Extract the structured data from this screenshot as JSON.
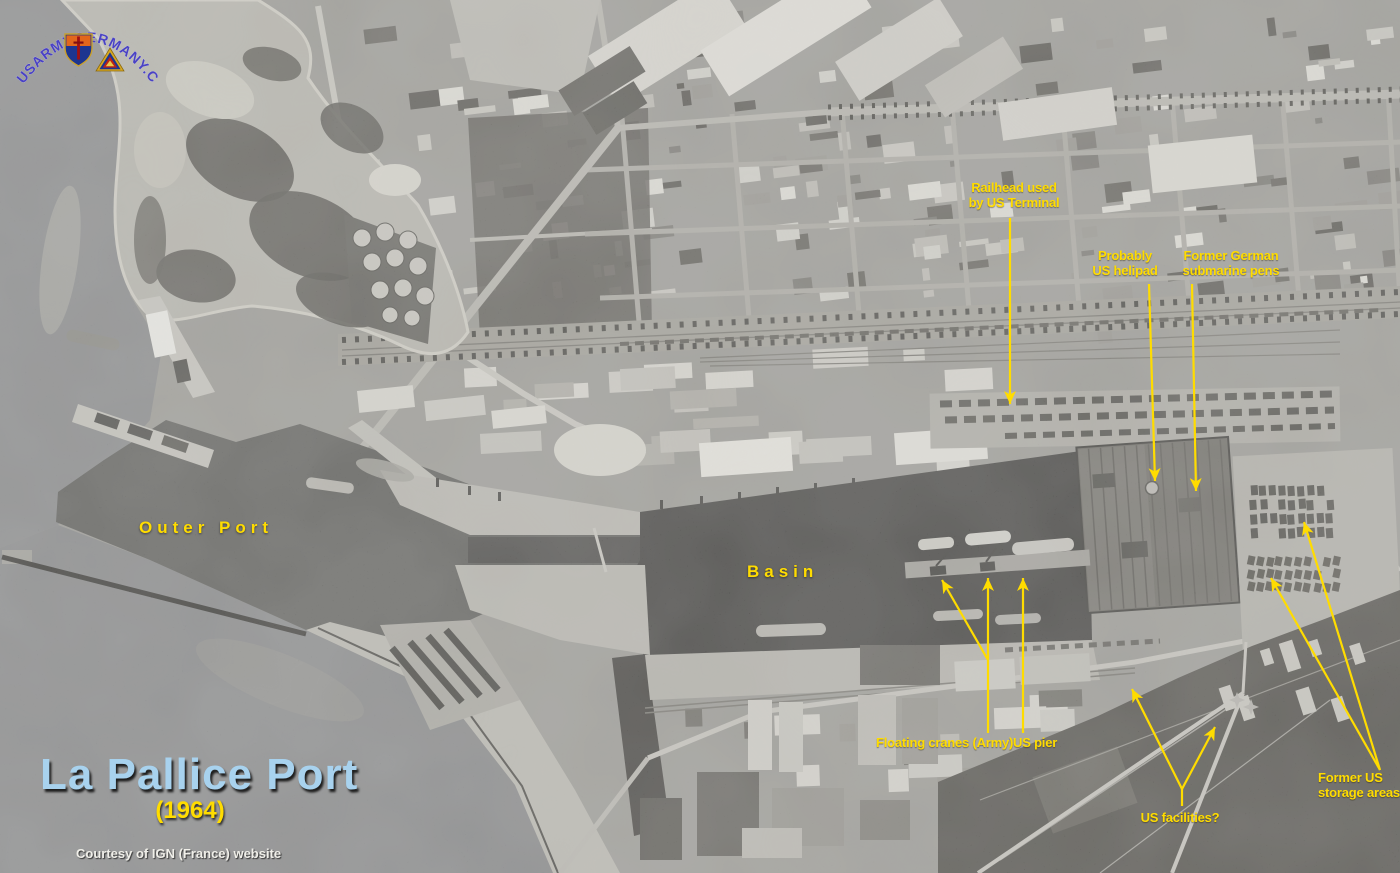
{
  "logo": {
    "text": "USARMYGERMANY.COM"
  },
  "title": {
    "main": "La Pallice Port",
    "year": "(1964)",
    "credit": "Courtesy of IGN (France) website"
  },
  "place_labels": {
    "outer_port": "Outer Port",
    "basin": "Basin"
  },
  "annotations": {
    "railhead": "Railhead used\nby US Terminal",
    "helipad": "Probably\nUS helipad",
    "submarine_pens": "Former German\nsubmarine pens",
    "floating_cranes": "Floating cranes (Army)",
    "us_pier": "US pier",
    "us_facilities": "US facilities?",
    "storage_areas": "Former US\nstorage areas"
  },
  "colors": {
    "annotation_yellow": "#FFDC00",
    "title_blue": "#A8D2EE",
    "logo_blue": "#4A42C4"
  }
}
